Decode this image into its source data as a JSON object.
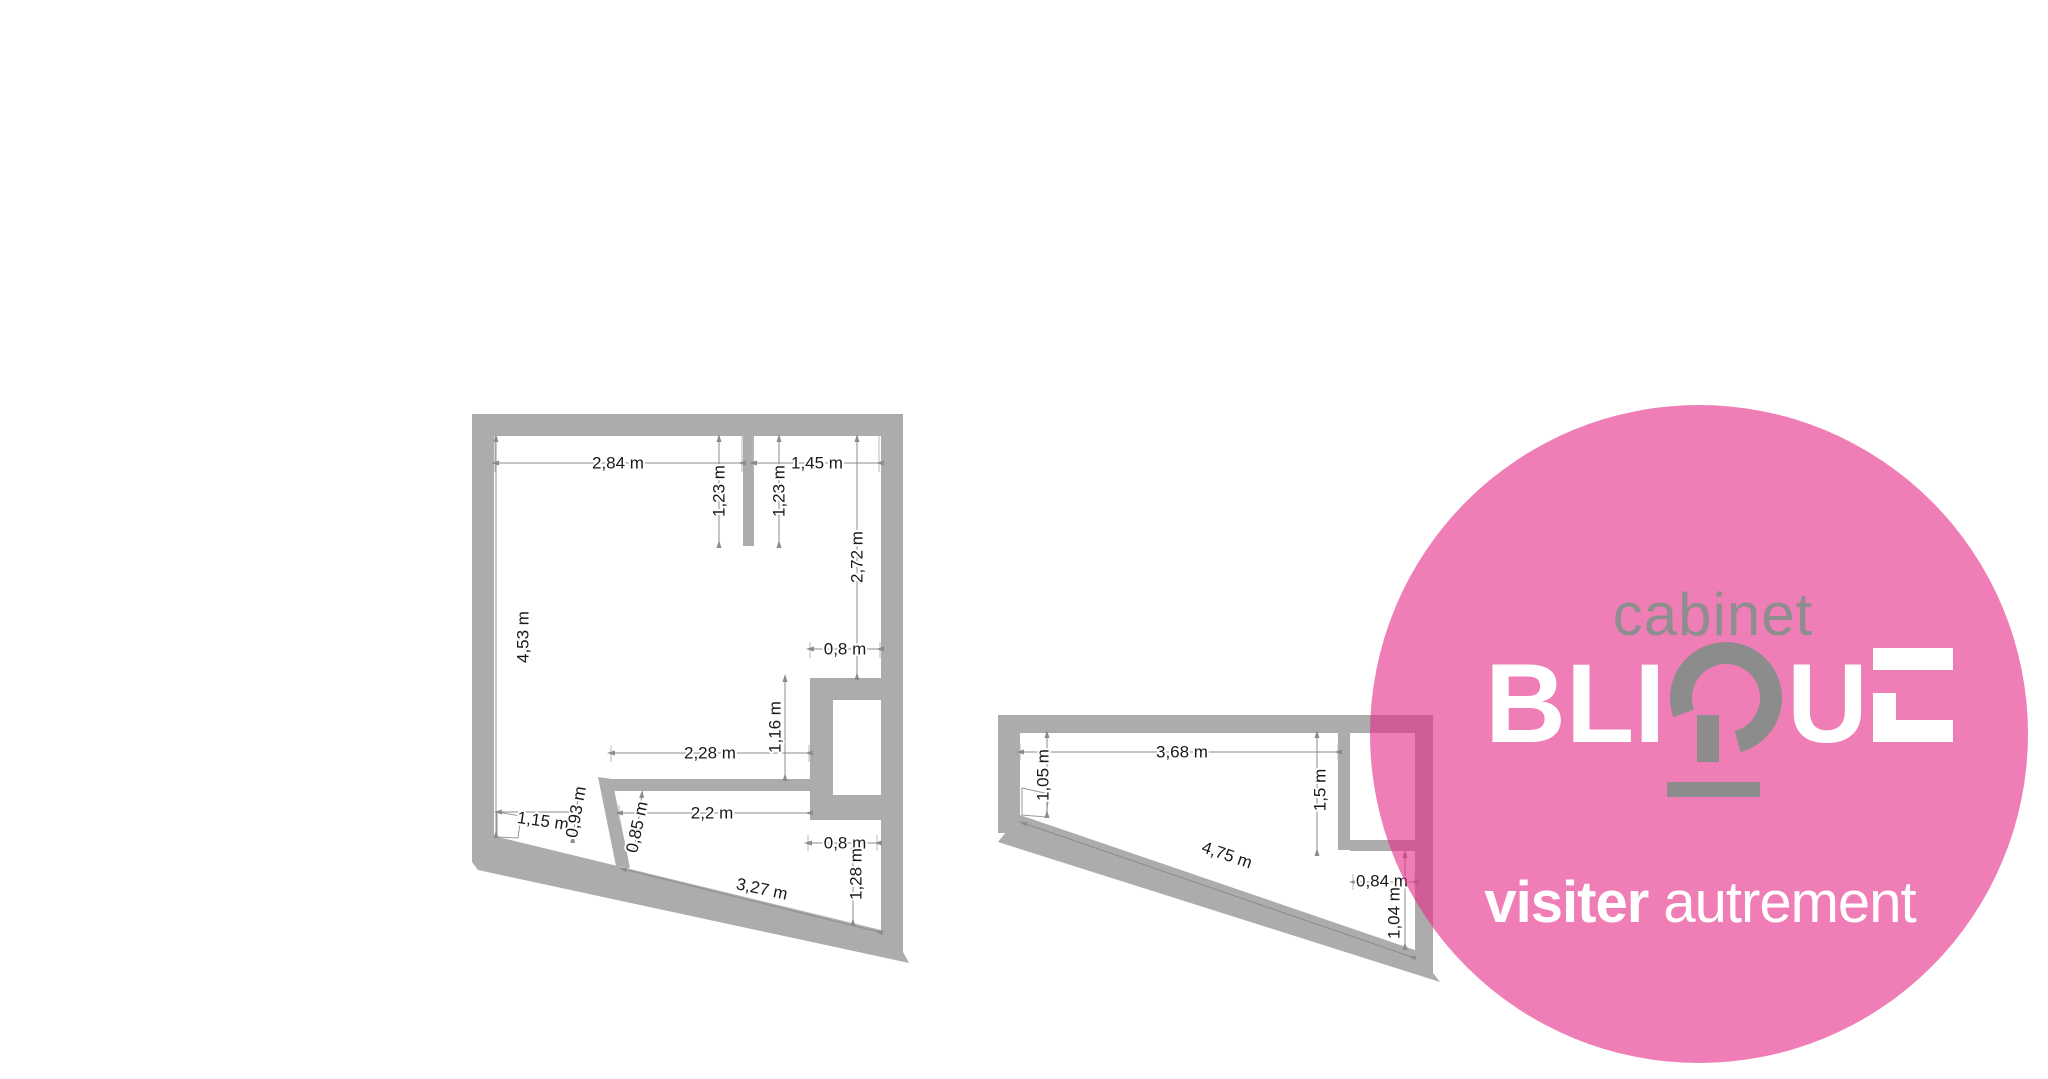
{
  "colors": {
    "wall": "#ACACAC",
    "dim_line": "#8c8c8c",
    "ext_line": "#b8b8b8",
    "dim_text": "#191919",
    "pink_overlay": "rgba(231,47,137,0.62)",
    "pink_solid": "#F07EB6",
    "logo_gray": "#8C8C8C",
    "logo_white": "#ffffff"
  },
  "logo": {
    "kicker": "cabinet",
    "brand_name": "BLIQUE",
    "brand_pre": "BLI",
    "brand_post": "U",
    "q_glyph": "stylized-q-icon",
    "tagline_bold": "visiter ",
    "tagline_light": "autrement"
  },
  "plans": [
    {
      "name": "floor-plan-left",
      "labels": [
        {
          "text": "2,84 m",
          "x": 618,
          "y": 463,
          "rot": 0
        },
        {
          "text": "1,23 m",
          "x": 719,
          "y": 491,
          "rot": -90
        },
        {
          "text": "1,23 m",
          "x": 779,
          "y": 491,
          "rot": -90
        },
        {
          "text": "1,45 m",
          "x": 817,
          "y": 463,
          "rot": 0
        },
        {
          "text": "2,72 m",
          "x": 857,
          "y": 557,
          "rot": -90
        },
        {
          "text": "4,53 m",
          "x": 523,
          "y": 637,
          "rot": -90
        },
        {
          "text": "0,8 m",
          "x": 845,
          "y": 649,
          "rot": 0
        },
        {
          "text": "1,16 m",
          "x": 775,
          "y": 727,
          "rot": -90
        },
        {
          "text": "2,28 m",
          "x": 710,
          "y": 753,
          "rot": 0
        },
        {
          "text": "2,2 m",
          "x": 712,
          "y": 813,
          "rot": 0
        },
        {
          "text": "1,15 m",
          "x": 543,
          "y": 821,
          "rot": 8
        },
        {
          "text": "0,93 m",
          "x": 576,
          "y": 812,
          "rot": -80
        },
        {
          "text": "0,85 m",
          "x": 637,
          "y": 827,
          "rot": -78
        },
        {
          "text": "3,27 m",
          "x": 762,
          "y": 889,
          "rot": 12
        },
        {
          "text": "0,8 m",
          "x": 845,
          "y": 843,
          "rot": 0
        },
        {
          "text": "1,28 m",
          "x": 856,
          "y": 874,
          "rot": -90
        }
      ]
    },
    {
      "name": "floor-plan-right",
      "labels": [
        {
          "text": "3,68 m",
          "x": 1182,
          "y": 752,
          "rot": 0
        },
        {
          "text": "1,05 m",
          "x": 1043,
          "y": 775,
          "rot": -90
        },
        {
          "text": "1,5 m",
          "x": 1320,
          "y": 790,
          "rot": -90
        },
        {
          "text": "4,75 m",
          "x": 1227,
          "y": 855,
          "rot": 19
        },
        {
          "text": "0,84 m",
          "x": 1382,
          "y": 881,
          "rot": 0
        },
        {
          "text": "1,04 m",
          "x": 1394,
          "y": 913,
          "rot": -90
        }
      ]
    }
  ]
}
